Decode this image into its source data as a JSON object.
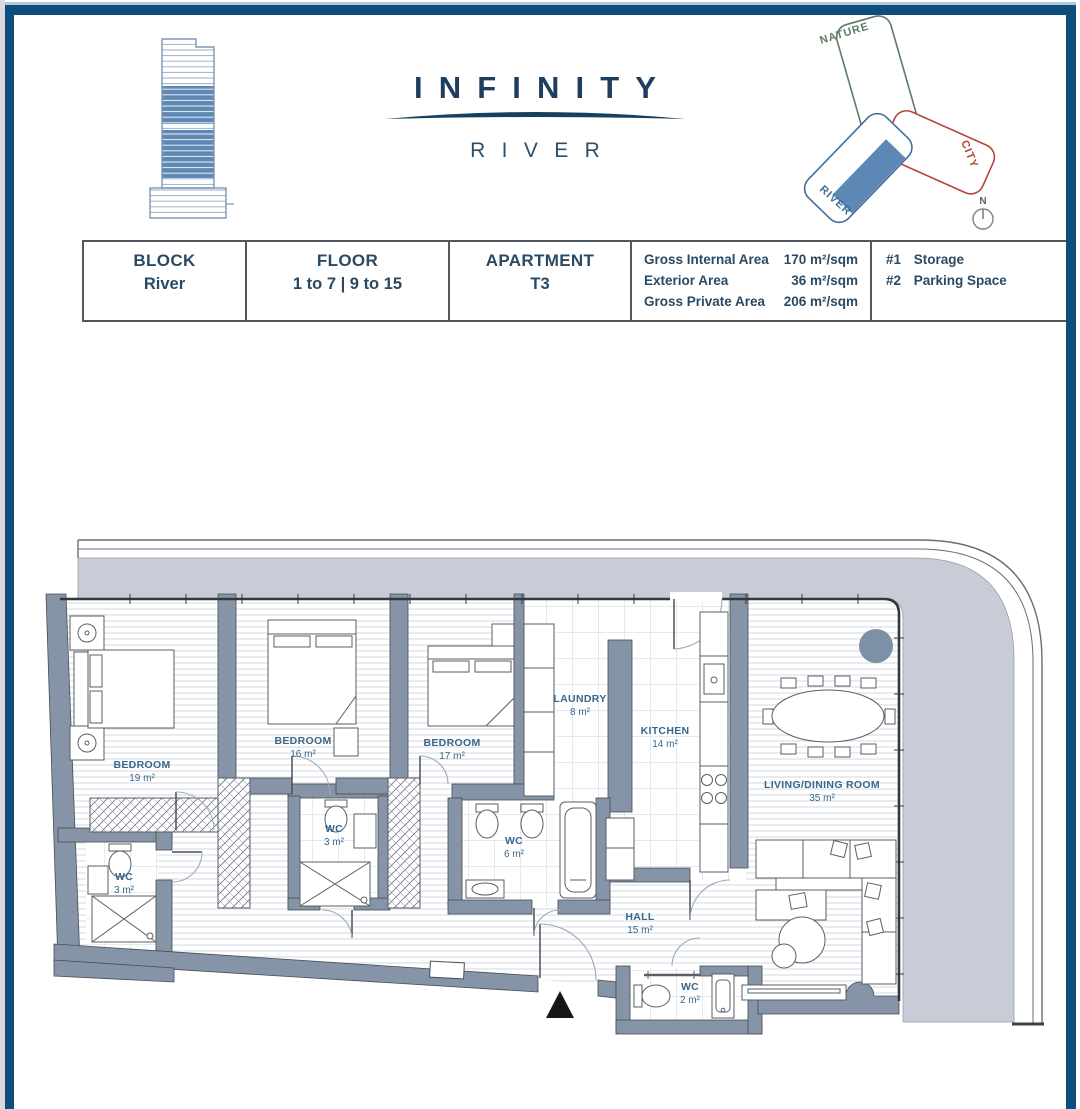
{
  "brand": {
    "title": "INFINITY",
    "subtitle": "RIVER",
    "title_color": "#1d3e5e",
    "swoosh_color": "#16405f"
  },
  "site_plan": {
    "labels": {
      "nature": "NATURE",
      "city": "CITY",
      "river": "RIVER"
    },
    "colors": {
      "nature": "#5e7c63",
      "city": "#b4473d",
      "river": "#3f6f9a",
      "highlight": "#5d88b5"
    },
    "compass_label": "N"
  },
  "info_table": {
    "columns": [
      {
        "header": "BLOCK",
        "value": "River"
      },
      {
        "header": "FLOOR",
        "value": "1 to 7 | 9 to 15"
      },
      {
        "header": "APARTMENT",
        "value": "T3"
      }
    ],
    "areas": [
      {
        "label": "Gross Internal Area",
        "value": "170 m²/sqm"
      },
      {
        "label": "Exterior Area",
        "value": "36 m²/sqm"
      },
      {
        "label": "Gross Private Area",
        "value": "206 m²/sqm"
      }
    ],
    "extras": [
      {
        "label": "#1",
        "value": "Storage"
      },
      {
        "label": "#2",
        "value": "Parking Space"
      }
    ]
  },
  "floor_plan": {
    "colors": {
      "wall": "#8694a8",
      "terrace": "#c7ccd7",
      "label": "#38678b"
    },
    "rooms": [
      {
        "id": "bedroom-1",
        "name": "BEDROOM",
        "area": "19 m²"
      },
      {
        "id": "bedroom-2",
        "name": "BEDROOM",
        "area": "16 m²"
      },
      {
        "id": "bedroom-3",
        "name": "BEDROOM",
        "area": "17 m²"
      },
      {
        "id": "laundry",
        "name": "LAUNDRY",
        "area": "8 m²"
      },
      {
        "id": "kitchen",
        "name": "KITCHEN",
        "area": "14 m²"
      },
      {
        "id": "living",
        "name": "LIVING/DINING ROOM",
        "area": "35 m²"
      },
      {
        "id": "wc-1",
        "name": "WC",
        "area": "3 m²"
      },
      {
        "id": "wc-2",
        "name": "WC",
        "area": "3 m²"
      },
      {
        "id": "wc-3",
        "name": "WC",
        "area": "6 m²"
      },
      {
        "id": "hall",
        "name": "HALL",
        "area": "15 m²"
      },
      {
        "id": "wc-4",
        "name": "WC",
        "area": "2 m²"
      }
    ]
  }
}
